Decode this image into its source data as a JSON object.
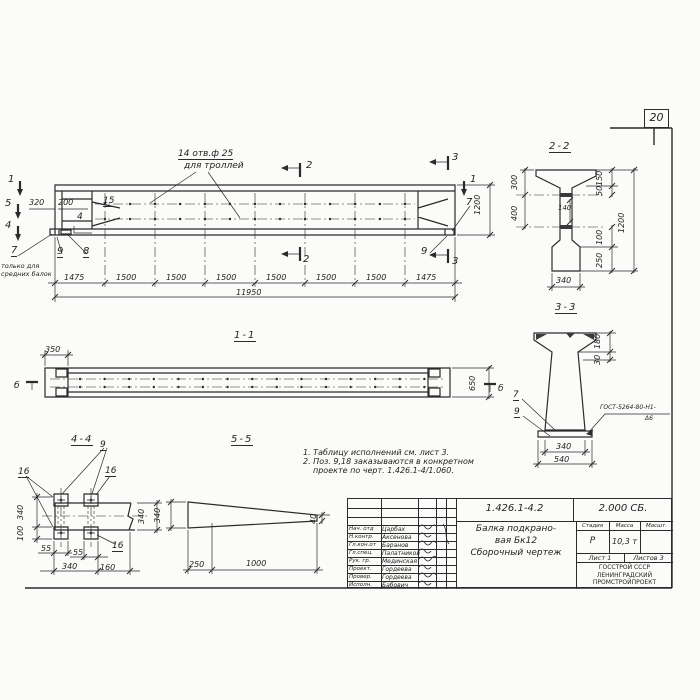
{
  "page": {
    "number": "20"
  },
  "colors": {
    "ink": "#2b2b2b",
    "paper": "#fbfbf9"
  },
  "elevation": {
    "holes_note_line1": "14 отв.ф 25",
    "holes_note_line2": "для троллей",
    "mark_1": "1",
    "mark_5": "5",
    "mark_4": "4",
    "mark_2": "2",
    "mark_3": "3",
    "dim_320": "320",
    "dim_200": "200",
    "pos_15": "15",
    "pos_4": "4",
    "pos_7": "7",
    "pos_8": "8",
    "pos_9": "9",
    "note_7_line1": "только для",
    "note_7_line2": "средних балок",
    "chain": [
      "1475",
      "1500",
      "1500",
      "1500",
      "1500",
      "1500",
      "1500",
      "1475"
    ],
    "dim_total": "11950",
    "dim_height": "1200"
  },
  "section_2_2": {
    "title": "2-2",
    "d300": "300",
    "d400": "400",
    "d150": "150",
    "d50": "50",
    "d1200": "1200",
    "d100": "100",
    "d250": "250",
    "d140": "140",
    "d340": "340"
  },
  "section_3_3": {
    "title": "3-3",
    "d180": "180",
    "d30": "30",
    "d340": "340",
    "d540": "540",
    "pos_7": "7",
    "pos_9": "9",
    "weld_line1": "ГОСТ-5264-80-Н1-",
    "weld_line2": "Δ6"
  },
  "view_1_1": {
    "title": "1-1",
    "d350": "350",
    "d650": "650",
    "mark_b": "б"
  },
  "view_4_4": {
    "title": "4-4",
    "pos_9": "9",
    "pos_16": "16",
    "d340_left": "340",
    "d100": "100",
    "d55": "55",
    "d340_bottom": "340",
    "d160": "160",
    "d340_right": "340"
  },
  "view_5_5": {
    "title": "5-5",
    "d340": "340",
    "d40": "40",
    "d250": "250",
    "d1000": "1000"
  },
  "notes": {
    "line1": "1. Таблицу исполнений см. лист 3.",
    "line2": "2. Поз. 9,18 заказываются в конкретном",
    "line3": "проекте по черт. 1.426.1-4/1.060."
  },
  "titleblock": {
    "doc_number": "1.426.1-4.2",
    "doc_code": "2.000 СБ.",
    "title_line1": "Балка подкрано-",
    "title_line2": "вая Бк12",
    "title_line3": "Сборочный чертеж",
    "col_stage": "Стадия",
    "col_mass": "Масса",
    "col_scale": "Масшт.",
    "stage": "Р",
    "mass": "10,3 т",
    "sheet": "Лист 1",
    "sheets": "Листов 3",
    "org_line1": "ГОССТРОЙ СССР",
    "org_line2": "ЛЕНИНГРАДСКИЙ",
    "org_line3": "ПРОМСТРОЙПРОЕКТ",
    "rows": [
      {
        "role": "Нач. отд",
        "name": "Царбах"
      },
      {
        "role": "Н.контр.",
        "name": "Аксенова"
      },
      {
        "role": "Гл.кон.от",
        "name": "Баранов"
      },
      {
        "role": "Гл.спец.",
        "name": "Палатников"
      },
      {
        "role": "Рук. гр.",
        "name": "Мединская"
      },
      {
        "role": "Проект.",
        "name": "Гордеева"
      },
      {
        "role": "Провер.",
        "name": "Гордеева"
      },
      {
        "role": "Исполн.",
        "name": "Бабович"
      }
    ]
  }
}
